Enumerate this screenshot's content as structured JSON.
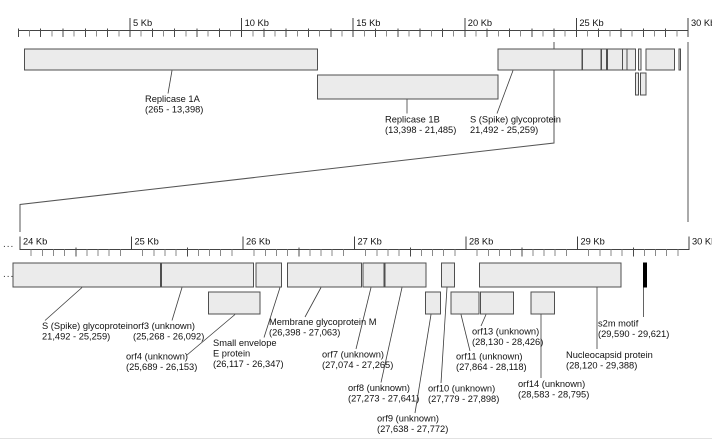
{
  "ellipsis": "...",
  "colors": {
    "background": "#ffffff",
    "box_fill": "#ebebeb",
    "box_stroke": "#4f4f4f",
    "ruler_line": "#444444",
    "tick_minor": "#8a8a8a",
    "tick_mid": "#4a4a4a",
    "tick_major": "#3f3f3f",
    "leader_line": "#3c3c3c",
    "connector_line": "#555555",
    "text": "#111111",
    "s2m_fill": "#000000",
    "window_edge": "#e2e2e2"
  },
  "layout": {
    "top": {
      "x0": 18.4,
      "px_per_kb": 22.32,
      "ruler_y": 30.5,
      "row1_y": 49,
      "row1_h": 21,
      "rowB_y": 75,
      "rowB_h": 24,
      "row2_y": 73,
      "row2_h": 22
    },
    "bottom": {
      "x0": 20,
      "origin_kb": 24,
      "px_per_kb": 111.5,
      "ruler_y": 249.5,
      "clip_left_x": 13,
      "row1_y": 263,
      "row1_h": 24,
      "row2_y": 292,
      "row2_h": 22
    }
  },
  "rulers": {
    "top": {
      "unit": "Kb",
      "start_kb": 0,
      "end_kb": 30,
      "minor_step_kb": 0.5,
      "mid_step_kb": 1,
      "labeled_ticks": [
        {
          "kb": 5,
          "label": "5 Kb"
        },
        {
          "kb": 10,
          "label": "10 Kb"
        },
        {
          "kb": 15,
          "label": "15 Kb"
        },
        {
          "kb": 20,
          "label": "20 Kb"
        },
        {
          "kb": 25,
          "label": "25 Kb"
        },
        {
          "kb": 30,
          "label": "30 Kb"
        }
      ],
      "major_top_y": 18,
      "major_bot_y": 37,
      "mid_top_y": 28.5,
      "mid_bot_y": 37,
      "minor_bot_y": 36.5,
      "label_baseline_y": 26
    },
    "bottom": {
      "unit": "Kb",
      "start_kb": 24,
      "end_kb": 30,
      "minor_step_kb": 0.1,
      "mid_step_kb": 0.5,
      "labeled_ticks": [
        {
          "kb": 24,
          "label": "24 Kb"
        },
        {
          "kb": 25,
          "label": "25 Kb"
        },
        {
          "kb": 26,
          "label": "26 Kb"
        },
        {
          "kb": 27,
          "label": "27 Kb"
        },
        {
          "kb": 28,
          "label": "28 Kb"
        },
        {
          "kb": 29,
          "label": "29 Kb"
        },
        {
          "kb": 30,
          "label": "30 Kb"
        }
      ],
      "major_top_y": 236.5,
      "major_bot_y": 250,
      "mid_top_y": 247.5,
      "mid_bot_y": 256.5,
      "minor_bot_y": 256,
      "label_baseline_y": 244.5
    }
  },
  "features": [
    {
      "id": "replicase-1a",
      "start_bp": 265,
      "end_bp": 13398,
      "top_row": "row1",
      "bottom_row": null,
      "style": "normal"
    },
    {
      "id": "replicase-1b",
      "start_bp": 13398,
      "end_bp": 21485,
      "top_row": "rowB",
      "bottom_row": null,
      "style": "normal"
    },
    {
      "id": "s-glycoprotein",
      "start_bp": 21492,
      "end_bp": 25259,
      "top_row": "row1",
      "bottom_row": "row1",
      "style": "normal"
    },
    {
      "id": "orf3",
      "start_bp": 25268,
      "end_bp": 26092,
      "top_row": "row1",
      "bottom_row": "row1",
      "style": "normal"
    },
    {
      "id": "orf4",
      "start_bp": 25689,
      "end_bp": 26153,
      "top_row": null,
      "bottom_row": "row2",
      "style": "normal"
    },
    {
      "id": "e-protein",
      "start_bp": 26117,
      "end_bp": 26347,
      "top_row": "row1",
      "bottom_row": "row1",
      "style": "normal"
    },
    {
      "id": "m-protein",
      "start_bp": 26398,
      "end_bp": 27063,
      "top_row": "row1",
      "bottom_row": "row1",
      "style": "normal"
    },
    {
      "id": "orf7",
      "start_bp": 27074,
      "end_bp": 27265,
      "top_row": "row1",
      "bottom_row": "row1",
      "style": "normal"
    },
    {
      "id": "orf8",
      "start_bp": 27273,
      "end_bp": 27641,
      "top_row": "row1",
      "bottom_row": "row1",
      "style": "normal"
    },
    {
      "id": "orf9",
      "start_bp": 27638,
      "end_bp": 27772,
      "top_row": "row2",
      "bottom_row": "row2",
      "style": "normal"
    },
    {
      "id": "orf10",
      "start_bp": 27779,
      "end_bp": 27898,
      "top_row": "row1",
      "bottom_row": "row1",
      "style": "normal"
    },
    {
      "id": "orf11",
      "start_bp": 27864,
      "end_bp": 28118,
      "top_row": "row2",
      "bottom_row": "row2",
      "style": "normal"
    },
    {
      "id": "orf13",
      "start_bp": 28130,
      "end_bp": 28426,
      "top_row": null,
      "bottom_row": "row2",
      "style": "normal"
    },
    {
      "id": "orf14",
      "start_bp": 28583,
      "end_bp": 28795,
      "top_row": null,
      "bottom_row": "row2",
      "style": "normal"
    },
    {
      "id": "nucleocapsid",
      "start_bp": 28120,
      "end_bp": 29388,
      "top_row": "row1",
      "bottom_row": "row1",
      "style": "normal"
    },
    {
      "id": "s2m-motif",
      "start_bp": 29590,
      "end_bp": 29621,
      "top_row": "row1",
      "bottom_row": "row1",
      "style": "s2m"
    }
  ],
  "labels": {
    "top": [
      {
        "id": "replicase-1a",
        "lines": [
          "Replicase 1A",
          "(265 - 13,398)"
        ],
        "x": 145,
        "y": 95,
        "leader": [
          [
            172,
            70.5
          ],
          [
            168,
            93.5
          ]
        ]
      },
      {
        "id": "replicase-1b",
        "lines": [
          "Replicase 1B",
          "(13,398 - 21,485)"
        ],
        "x": 385,
        "y": 115.5,
        "leader": [
          [
            407,
            99.5
          ],
          [
            407,
            113.5
          ]
        ]
      },
      {
        "id": "s-glycoprotein",
        "lines": [
          "S (Spike) glycoprotein",
          "21,492 - 25,259)"
        ],
        "x": 470,
        "y": 115.5,
        "leader": [
          [
            513,
            70.5
          ],
          [
            497,
            113.5
          ]
        ]
      }
    ],
    "bottom": [
      {
        "id": "s-glycoprotein",
        "lines": [
          "S (Spike) glycoprotein",
          "21,492 - 25,259)"
        ],
        "x": 42,
        "y": 322,
        "leader": [
          [
            82,
            287.5
          ],
          [
            45,
            320.5
          ]
        ]
      },
      {
        "id": "orf3",
        "lines": [
          "orf3 (unknown)",
          "(25,268 - 26,092)"
        ],
        "x": 133,
        "y": 322,
        "leader": [
          [
            182,
            287.5
          ],
          [
            172,
            320.5
          ]
        ]
      },
      {
        "id": "orf4",
        "lines": [
          "orf4 (unknown)",
          "(25,689 - 26,153)"
        ],
        "x": 126,
        "y": 352.5,
        "leader": [
          [
            235,
            314.5
          ],
          [
            187,
            355
          ]
        ]
      },
      {
        "id": "e-protein",
        "lines": [
          "Small envelope",
          "E protein",
          "(26,117 - 26,347)"
        ],
        "x": 213,
        "y": 339,
        "leader": [
          [
            280,
            287.5
          ],
          [
            264,
            337.5
          ]
        ]
      },
      {
        "id": "m-protein",
        "lines": [
          "Membrane glycoprotein M",
          "(26,398 - 27,063)"
        ],
        "x": 269,
        "y": 318,
        "leader": [
          [
            321,
            287.5
          ],
          [
            305,
            317
          ]
        ]
      },
      {
        "id": "orf7",
        "lines": [
          "orf7 (unknown)",
          "(27,074 - 27,265)"
        ],
        "x": 322,
        "y": 350.5,
        "leader": [
          [
            371,
            287.5
          ],
          [
            356,
            349
          ]
        ]
      },
      {
        "id": "orf8",
        "lines": [
          "orf8 (unknown)",
          "(27,273 - 27,641)"
        ],
        "x": 348,
        "y": 384,
        "leader": [
          [
            402,
            287.5
          ],
          [
            381,
            382.5
          ]
        ]
      },
      {
        "id": "orf9",
        "lines": [
          "orf9 (unknown)",
          "(27,638 - 27,772)"
        ],
        "x": 377,
        "y": 414.5,
        "leader": [
          [
            431,
            314.5
          ],
          [
            415,
            413
          ]
        ]
      },
      {
        "id": "orf10",
        "lines": [
          "orf10 (unknown)",
          "(27,779 - 27,898)"
        ],
        "x": 428,
        "y": 384.5,
        "leader": [
          [
            447,
            287.5
          ],
          [
            441,
            383
          ]
        ]
      },
      {
        "id": "orf11",
        "lines": [
          "orf11 (unknown)",
          "(27,864 - 28,118)"
        ],
        "x": 456,
        "y": 352.5,
        "leader": [
          [
            461,
            314.5
          ],
          [
            470,
            351
          ]
        ]
      },
      {
        "id": "orf13",
        "lines": [
          "orf13 (unknown)",
          "(28,130 - 28,426)"
        ],
        "x": 472,
        "y": 327.5,
        "leader": [
          [
            486,
            314.5
          ],
          [
            481,
            326
          ]
        ]
      },
      {
        "id": "orf14",
        "lines": [
          "orf14 (unknown)",
          "(28,583 - 28,795)"
        ],
        "x": 518,
        "y": 380,
        "leader": [
          [
            541,
            314.5
          ],
          [
            541,
            378
          ]
        ]
      },
      {
        "id": "nucleocapsid",
        "lines": [
          "Nucleocapsid protein",
          "(28,120 - 29,388)"
        ],
        "x": 566,
        "y": 351,
        "leader": [
          [
            597,
            287.5
          ],
          [
            597,
            349
          ]
        ]
      },
      {
        "id": "s2m-motif",
        "lines": [
          "s2m motif",
          "(29,590 - 29,621)"
        ],
        "x": 598,
        "y": 319.5,
        "leader": [
          [
            643.5,
            287.5
          ],
          [
            643.5,
            317
          ]
        ]
      }
    ]
  },
  "connector": {
    "left": [
      [
        554,
        42
      ],
      [
        554,
        143
      ],
      [
        20,
        204.5
      ],
      [
        20,
        232
      ]
    ],
    "right": [
      [
        688,
        42
      ],
      [
        688,
        222
      ]
    ]
  }
}
